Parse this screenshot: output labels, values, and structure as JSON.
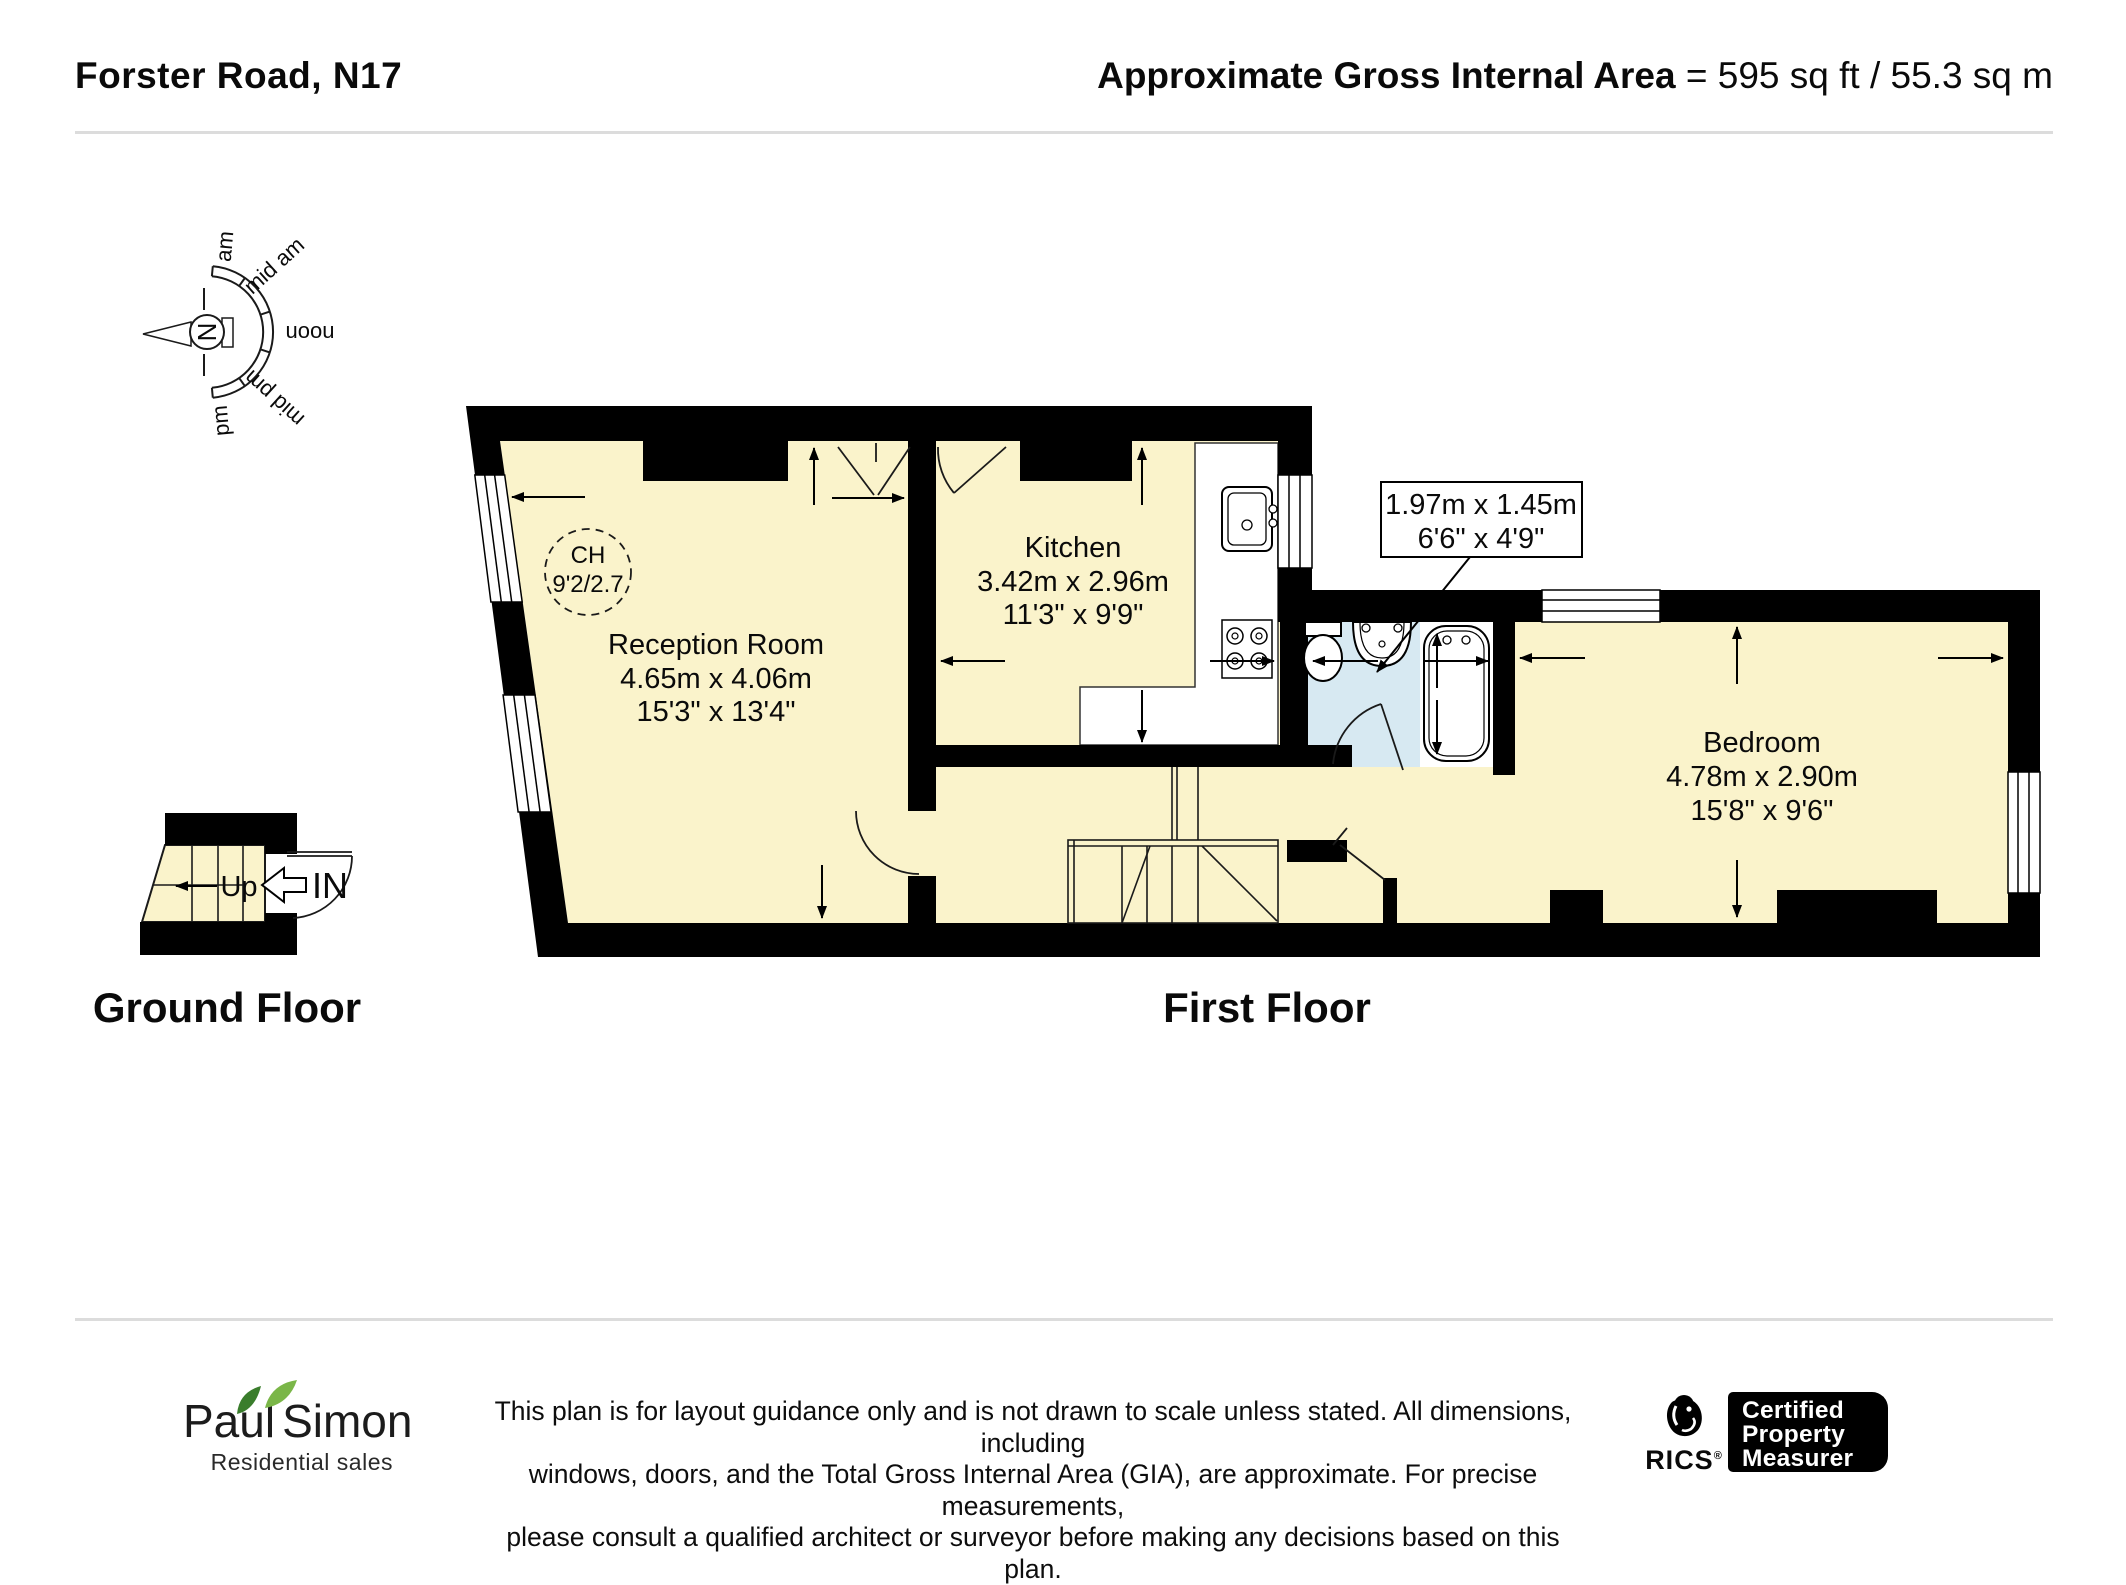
{
  "header": {
    "title": "Forster Road, N17",
    "gia_label": "Approximate Gross Internal Area",
    "gia_value": "= 595 sq ft / 55.3 sq m"
  },
  "compass": {
    "north": "N",
    "sectors": [
      "am",
      "mid am",
      "noon",
      "mid pm",
      "pm"
    ]
  },
  "floorplan": {
    "reception": {
      "name": "Reception Room",
      "metric": "4.65m x 4.06m",
      "imperial": "15'3\" x 13'4\""
    },
    "ceiling_height": {
      "label": "CH",
      "value": "9'2/2.7"
    },
    "kitchen": {
      "name": "Kitchen",
      "metric": "3.42m x 2.96m",
      "imperial": "11'3\" x 9'9\""
    },
    "bathroom_callout": {
      "metric": "1.97m x 1.45m",
      "imperial": "6'6\" x 4'9\""
    },
    "bedroom": {
      "name": "Bedroom",
      "metric": "4.78m x 2.90m",
      "imperial": "15'8\" x 9'6\""
    },
    "stairs_label": "Up",
    "entrance_label": "IN",
    "ground_floor_label": "Ground Floor",
    "first_floor_label": "First Floor"
  },
  "footer": {
    "logo_primary": "Paul",
    "logo_secondary": "Simon",
    "logo_tagline": "Residential sales",
    "disclaimer_lines": [
      "This plan is for layout guidance only and is not drawn to scale unless stated. All dimensions, including",
      "windows, doors, and the Total Gross Internal Area (GIA), are approximate. For precise measurements,",
      "please consult a qualified architect or surveyor before making any decisions based on this plan."
    ],
    "rics_label": "RICS",
    "rics_reg": "®",
    "cert_lines": [
      "Certified",
      "Property",
      "Measurer"
    ]
  },
  "colors": {
    "room_fill": "#FAF3CB",
    "bathroom_fill": "#D7E9F2",
    "wall": "#000000",
    "leaf_dark": "#3A7D2C",
    "leaf_light": "#7AB648"
  }
}
